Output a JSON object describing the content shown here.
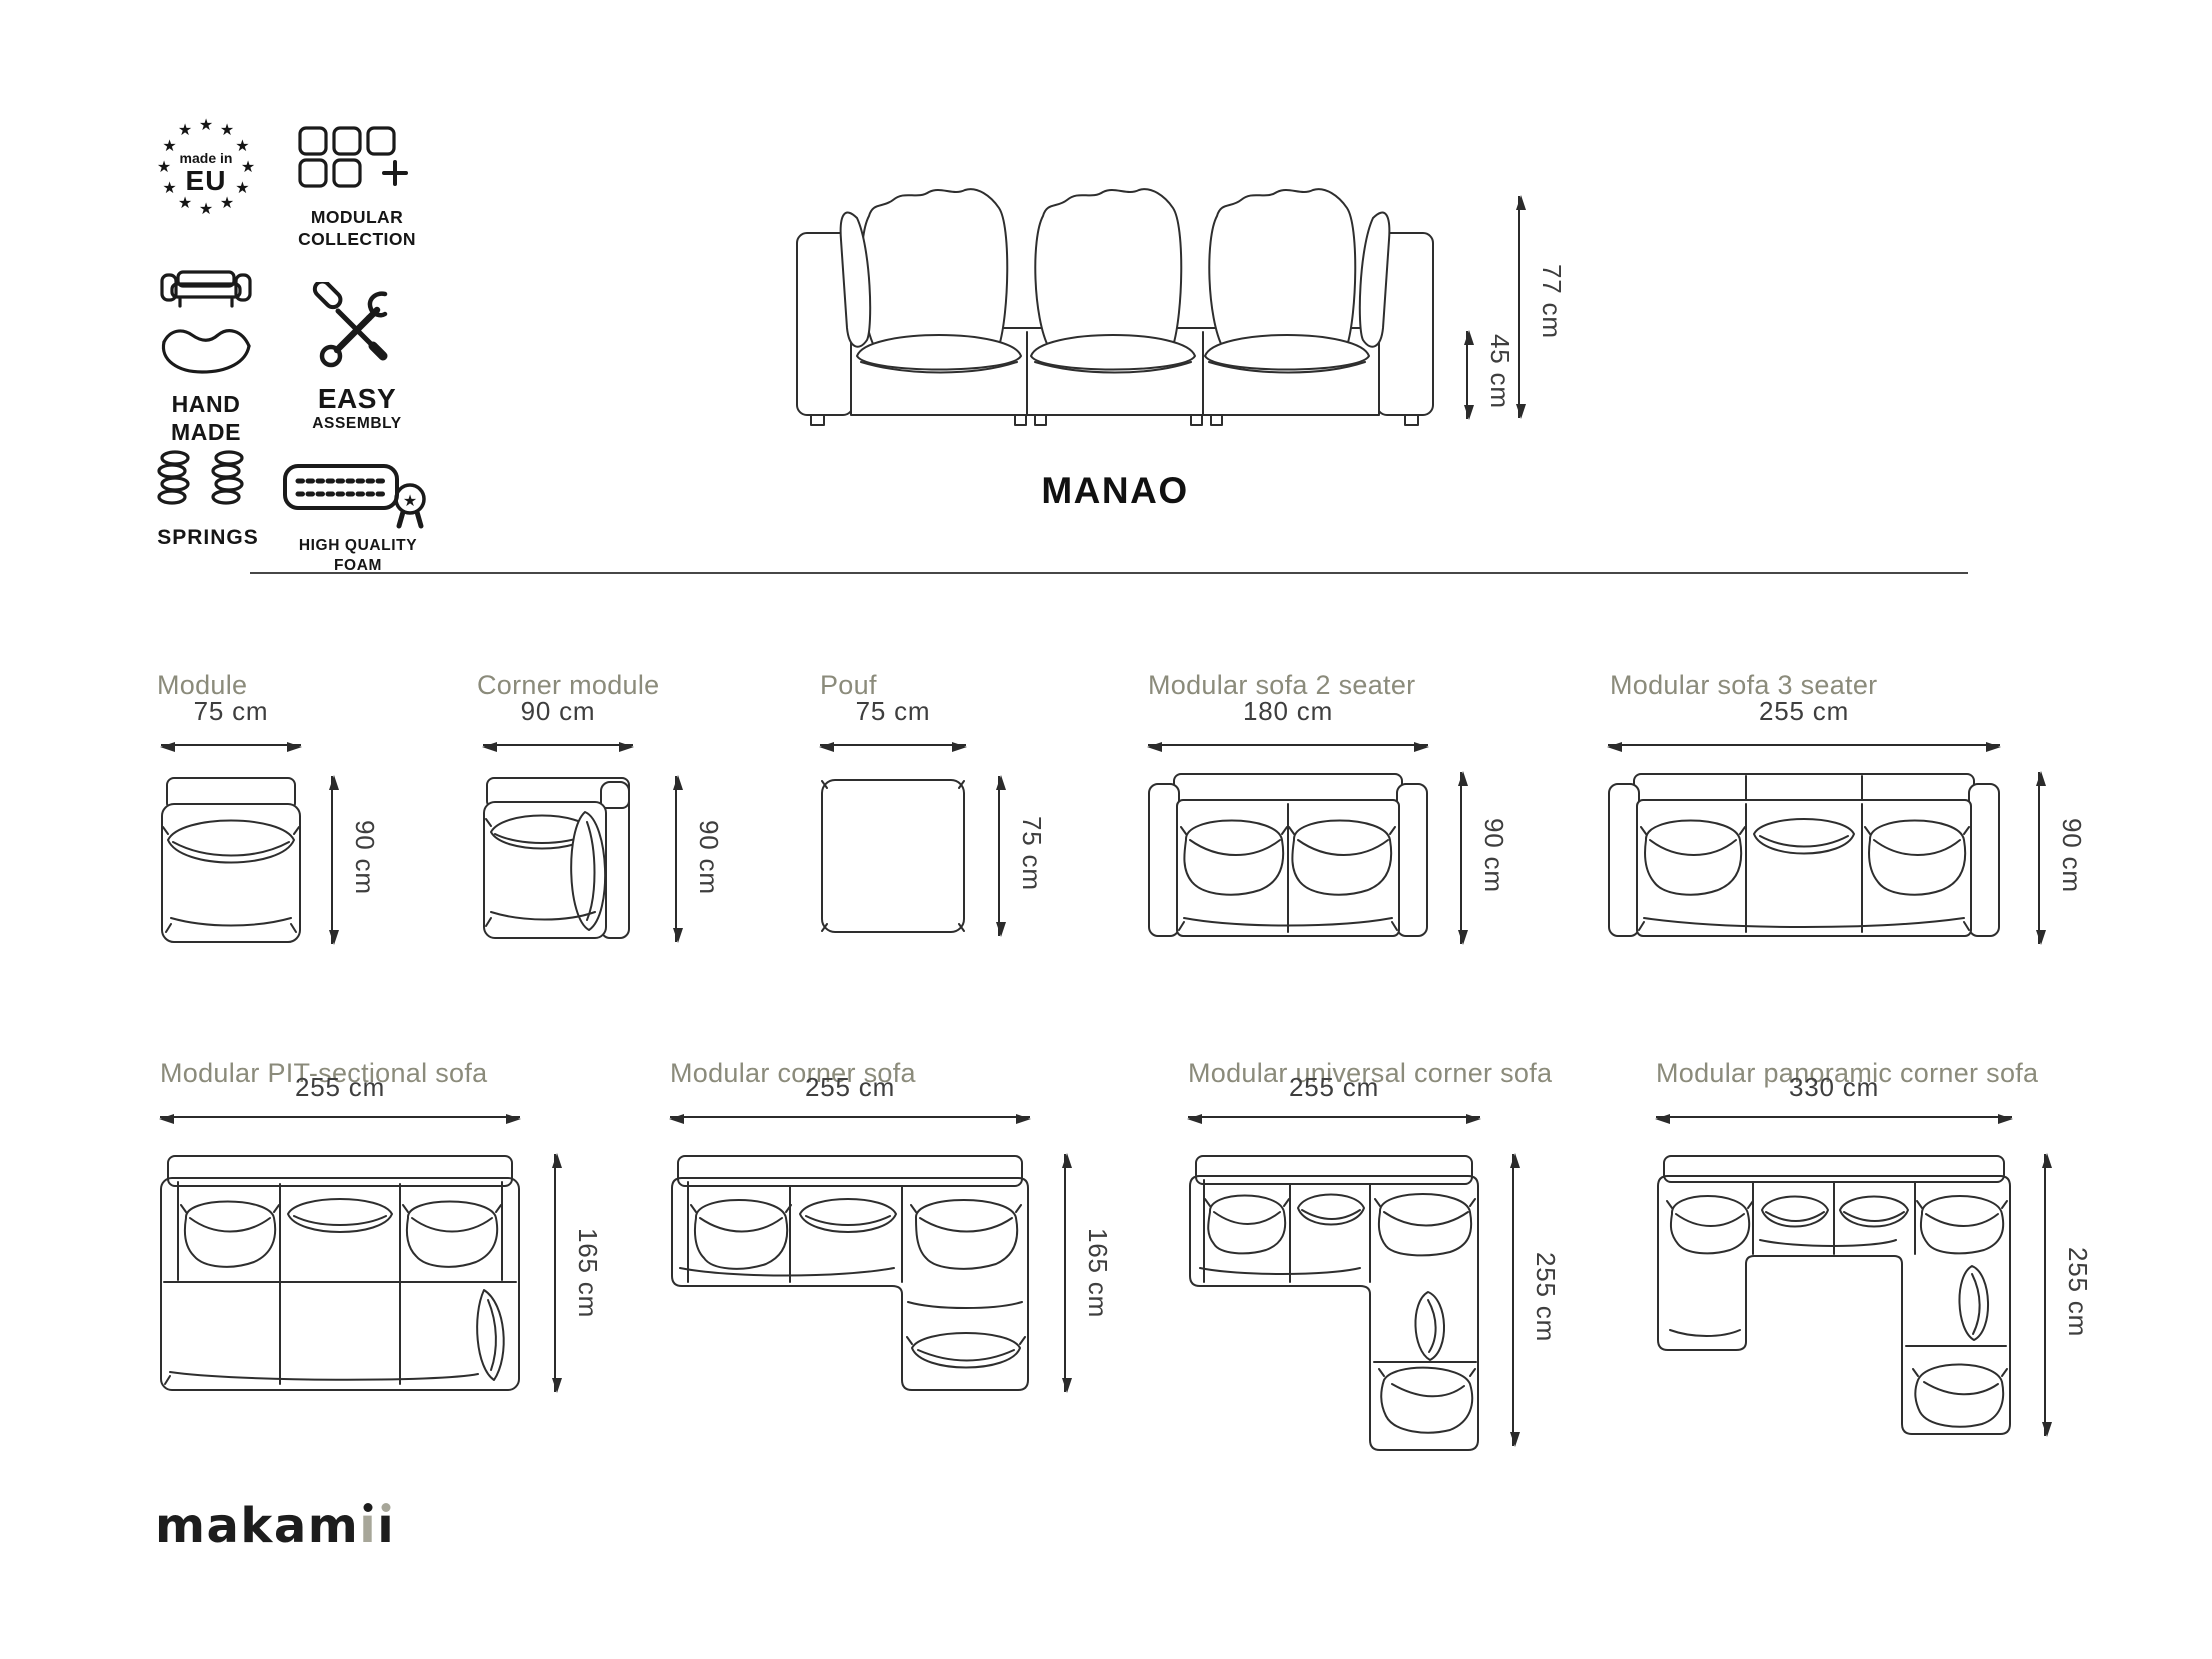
{
  "badges": {
    "made_in_eu": {
      "top": "made in",
      "bottom": "EU"
    },
    "modular_collection": {
      "line1": "MODULAR",
      "line2": "COLLECTION"
    },
    "hand_made": {
      "line1": "HAND",
      "line2": "MADE"
    },
    "easy_assembly": {
      "line1": "EASY",
      "line2": "ASSEMBLY"
    },
    "springs": {
      "label": "SPRINGS"
    },
    "high_quality_foam": {
      "line1": "HIGH QUALITY",
      "line2": "FOAM"
    }
  },
  "hero": {
    "title": "MANAO",
    "overall_height": "77 cm",
    "seat_height": "45 cm"
  },
  "products": [
    {
      "name": "Module",
      "width": "75 cm",
      "depth": "90 cm"
    },
    {
      "name": "Corner module",
      "width": "90 cm",
      "depth": "90 cm"
    },
    {
      "name": "Pouf",
      "width": "75 cm",
      "depth": "75 cm"
    },
    {
      "name": "Modular sofa 2 seater",
      "width": "180 cm",
      "depth": "90 cm"
    },
    {
      "name": "Modular sofa 3 seater",
      "width": "255 cm",
      "depth": "90 cm"
    },
    {
      "name": "Modular PIT-sectional sofa",
      "width": "255 cm",
      "depth": "165 cm"
    },
    {
      "name": "Modular corner sofa",
      "width": "255 cm",
      "depth": "165 cm"
    },
    {
      "name": "Modular universal corner sofa",
      "width": "255 cm",
      "depth": "255 cm"
    },
    {
      "name": "Modular panoramic corner sofa",
      "width": "330 cm",
      "depth": "255 cm"
    }
  ],
  "brand": {
    "logo_full": "makamii",
    "logo_prefix": "makam",
    "logo_stem": "ı"
  },
  "colors": {
    "title_olive": "#8b8b7b",
    "dimension_text": "#3e3e3e",
    "line_art": "#2e2e2e",
    "ink": "#161616",
    "logo_gray": "#a7a699"
  }
}
